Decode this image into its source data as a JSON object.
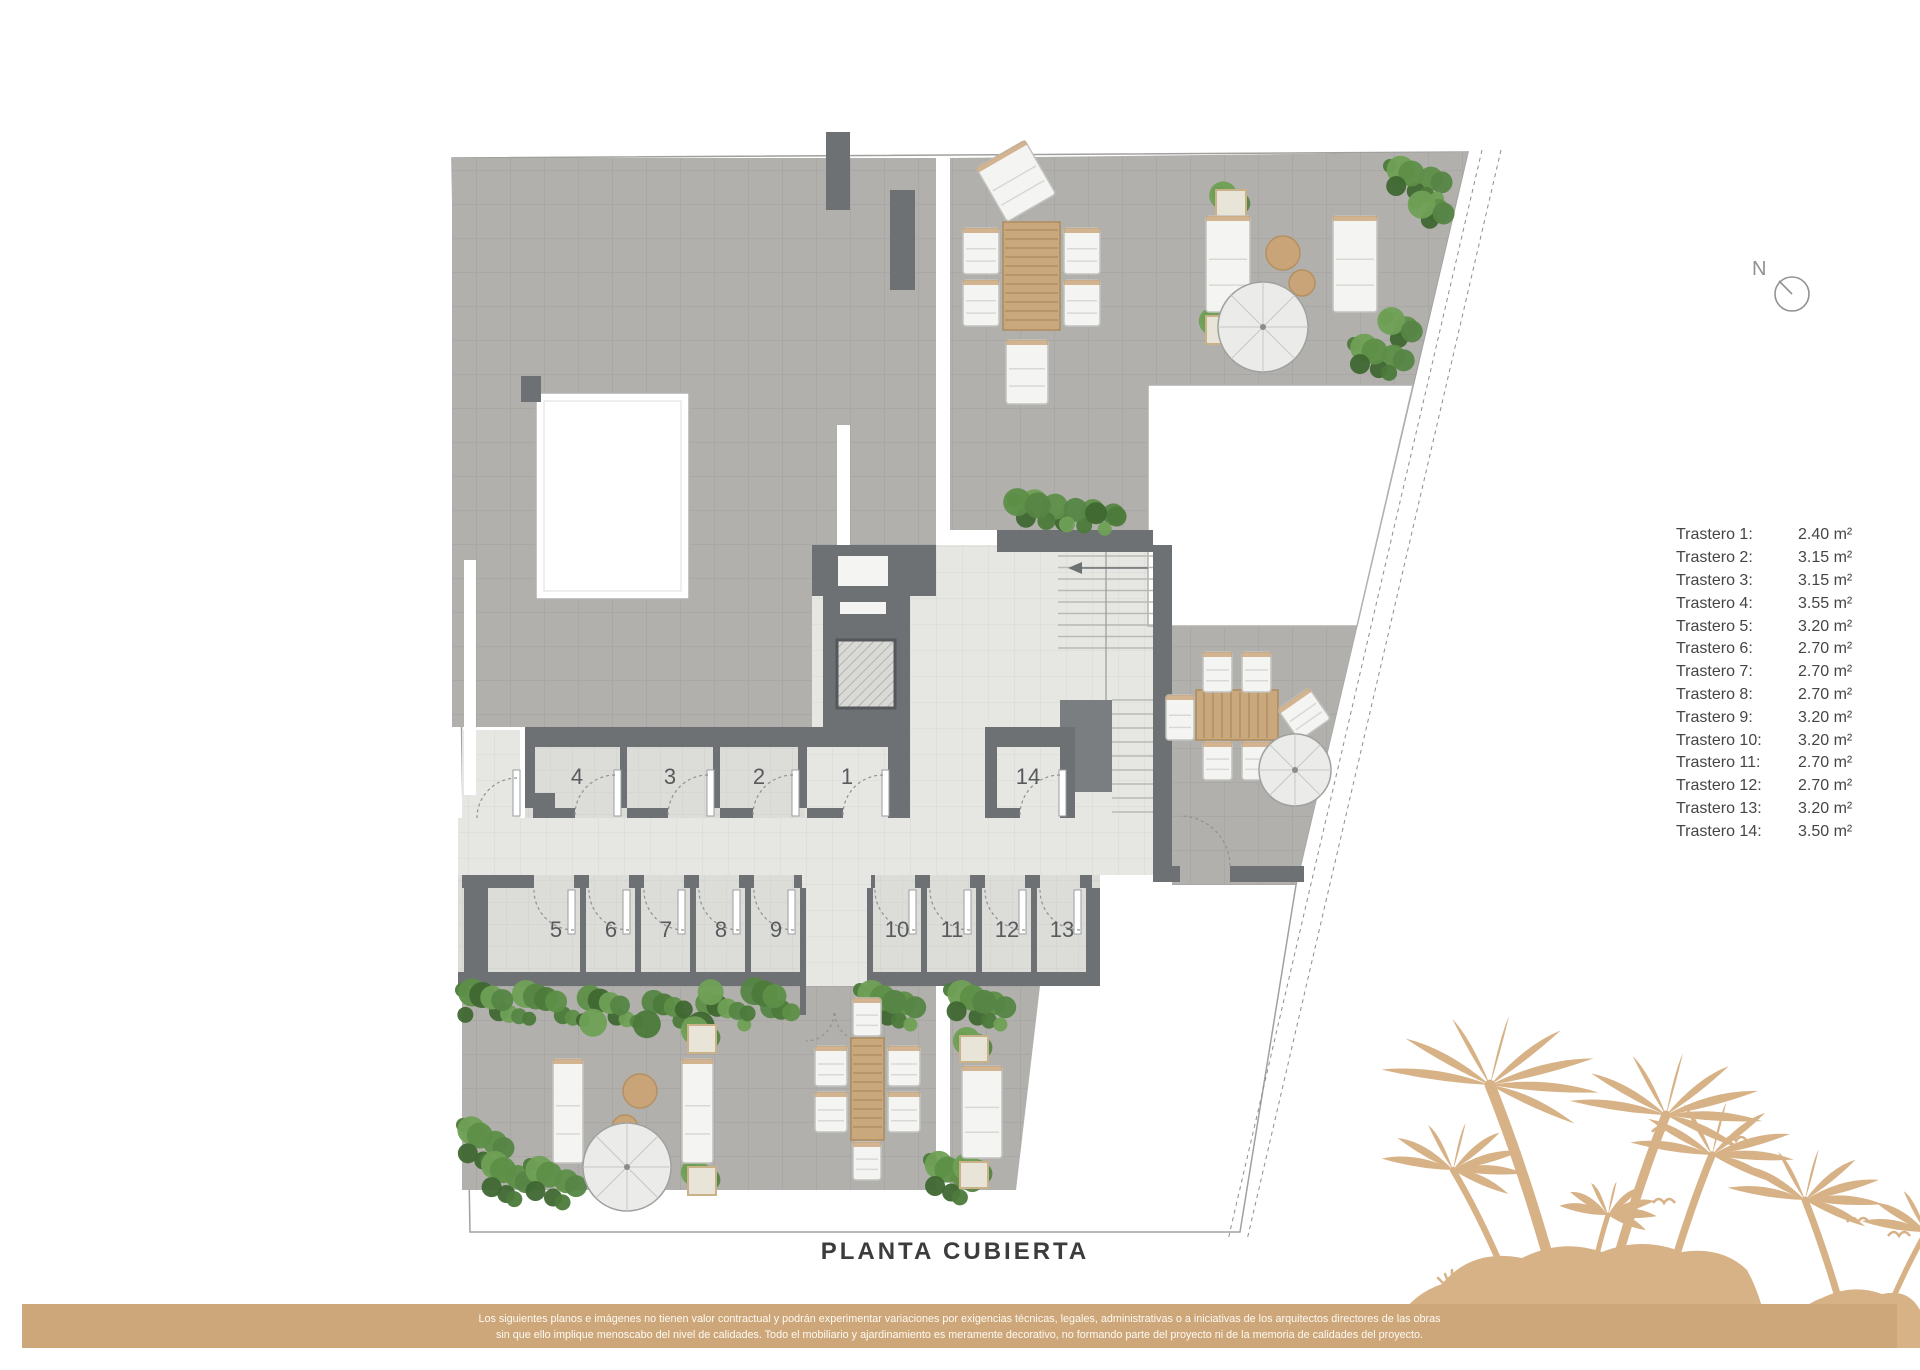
{
  "title": "PLANTA CUBIERTA",
  "north": {
    "label": "N"
  },
  "plan": {
    "rooms": [
      {
        "number": "4"
      },
      {
        "number": "3"
      },
      {
        "number": "2"
      },
      {
        "number": "1"
      },
      {
        "number": "14"
      },
      {
        "number": "5"
      },
      {
        "number": "6"
      },
      {
        "number": "7"
      },
      {
        "number": "8"
      },
      {
        "number": "9"
      },
      {
        "number": "10"
      },
      {
        "number": "11"
      },
      {
        "number": "12"
      },
      {
        "number": "13"
      }
    ]
  },
  "legend": {
    "rows": [
      {
        "label": "Trastero 1:",
        "value": "2.40 m²"
      },
      {
        "label": "Trastero 2:",
        "value": "3.15 m²"
      },
      {
        "label": "Trastero 3:",
        "value": "3.15 m²"
      },
      {
        "label": "Trastero 4:",
        "value": "3.55 m²"
      },
      {
        "label": "Trastero 5:",
        "value": "3.20 m²"
      },
      {
        "label": "Trastero 6:",
        "value": "2.70 m²"
      },
      {
        "label": "Trastero 7:",
        "value": "2.70 m²"
      },
      {
        "label": "Trastero 8:",
        "value": "2.70 m²"
      },
      {
        "label": "Trastero 9:",
        "value": "3.20 m²"
      },
      {
        "label": "Trastero 10:",
        "value": "3.20 m²"
      },
      {
        "label": "Trastero 11:",
        "value": "2.70 m²"
      },
      {
        "label": "Trastero 12:",
        "value": "2.70 m²"
      },
      {
        "label": "Trastero 13:",
        "value": "3.20 m²"
      },
      {
        "label": "Trastero 14:",
        "value": "3.50 m²"
      }
    ]
  },
  "footer": {
    "line1": "Los siguientes planos e imágenes no tienen valor contractual y podrán experimentar variaciones por exigencias técnicas, legales, administrativas o a iniciativas de los arquitectos directores de las obras",
    "line2": "sin que ello implique menoscabo del nivel de calidades. Todo el mobiliario y ajardinamiento es meramente decorativo, no formando parte del proyecto ni de la memoria de calidades del proyecto."
  },
  "colors": {
    "accent_tan": "#cda77a",
    "palm_tan": "#d8b287",
    "terrace_gray": "#b2b0ad",
    "wall_gray": "#6d7174"
  }
}
